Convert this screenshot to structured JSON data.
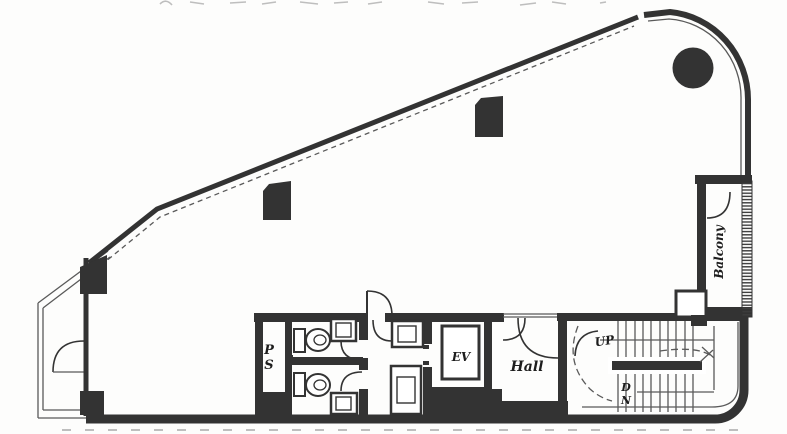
{
  "colors": {
    "background": "#fdfdfc",
    "wall": "#333333",
    "line": "#5a5a5a",
    "text": "#1d1d1d"
  },
  "plan": {
    "type": "floor-plan",
    "labels": {
      "pipe_shaft": {
        "line1": "P",
        "line2": "S"
      },
      "elevator": "EV",
      "hall": "Hall",
      "up": "UP",
      "down": {
        "line1": "D",
        "line2": "N"
      },
      "balcony": "Balcony"
    }
  }
}
